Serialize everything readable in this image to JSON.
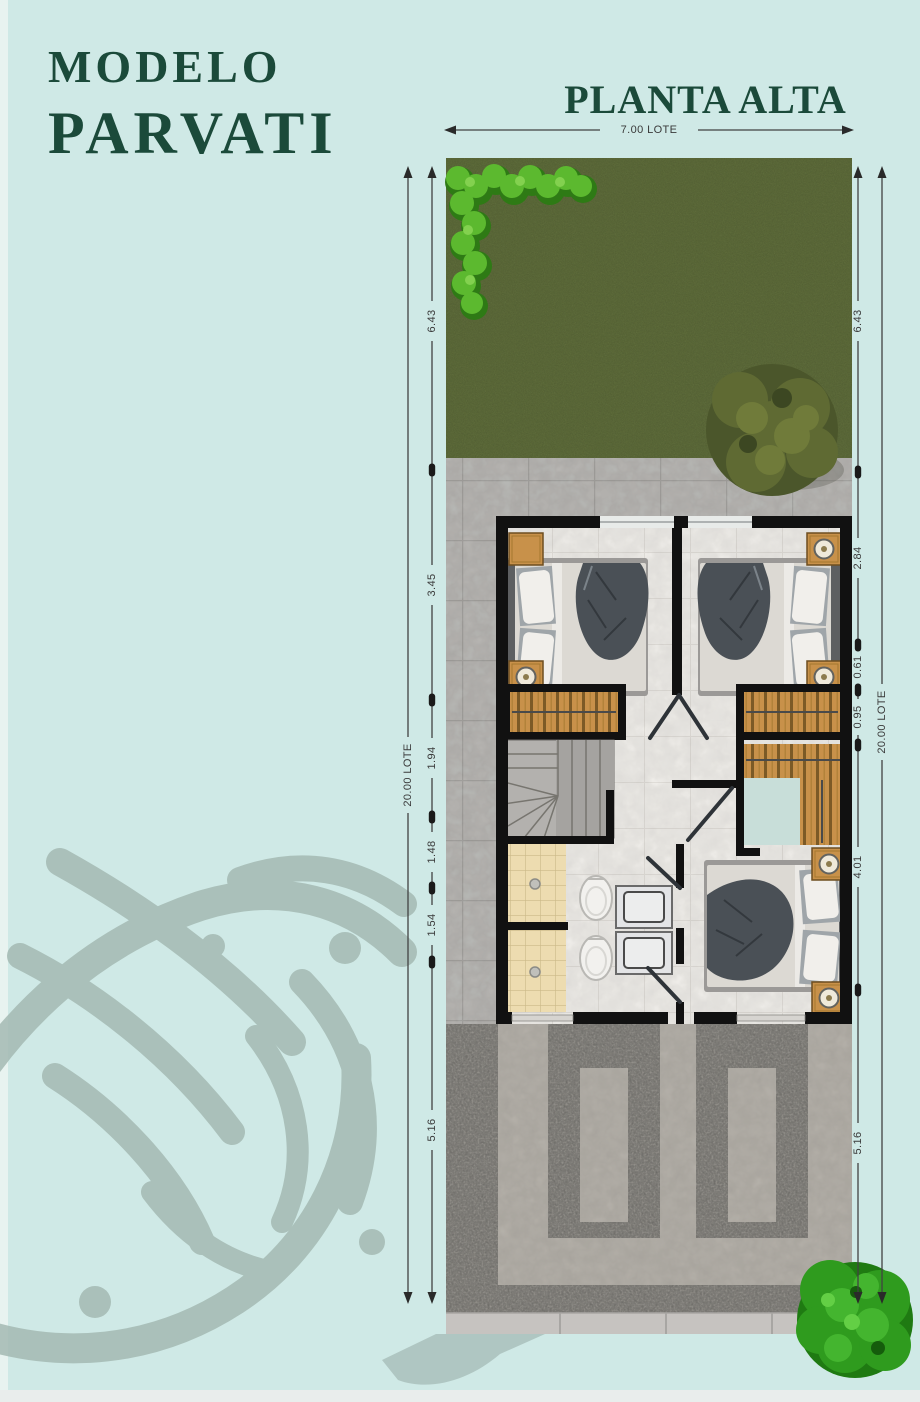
{
  "header": {
    "model_label": "MODELO",
    "model_name": "PARVATI",
    "floor_title": "PLANTA ALTA",
    "title_color": "#1b4a3a"
  },
  "dimensions": {
    "top_width": {
      "label": "7.00 LOTE"
    },
    "left_depth": {
      "label": "20.00 LOTE"
    },
    "right_depth": {
      "label": "20.00 LOTE"
    },
    "left_segments": [
      {
        "label": "6.43"
      },
      {
        "label": "3.45"
      },
      {
        "label": "1.94"
      },
      {
        "label": "1.48"
      },
      {
        "label": "1.54"
      },
      {
        "label": "5.16"
      }
    ],
    "right_segments": [
      {
        "label": "6.43"
      },
      {
        "label": "2.84"
      },
      {
        "label": "0.61"
      },
      {
        "label": "0.95"
      },
      {
        "label": "4.01"
      },
      {
        "label": "5.16"
      }
    ]
  },
  "colors": {
    "background": "#cfe9e6",
    "title_green": "#1b4a3a",
    "dimension_text": "#3a3a3a",
    "grass": "#5f6d3b",
    "hedge": "#5cb92f",
    "pavement": "#b4b2af",
    "wall": "#111111",
    "closet_wood": "#c8914a",
    "gravel": "#8b8984",
    "watermark": "#a4bab3"
  },
  "plan_features": [
    {
      "icon": "garden-grass-icon"
    },
    {
      "icon": "hedge-icon"
    },
    {
      "icon": "garden-tree-icon"
    },
    {
      "icon": "bed-icon"
    },
    {
      "icon": "nightstand-lamp-icon"
    },
    {
      "icon": "closet-icon"
    },
    {
      "icon": "winder-stairs-icon"
    },
    {
      "icon": "shower-icon"
    },
    {
      "icon": "toilet-icon"
    },
    {
      "icon": "vanity-sink-icon"
    },
    {
      "icon": "driveway-icon"
    },
    {
      "icon": "street-tree-icon"
    },
    {
      "icon": "lotus-watermark-icon"
    }
  ]
}
